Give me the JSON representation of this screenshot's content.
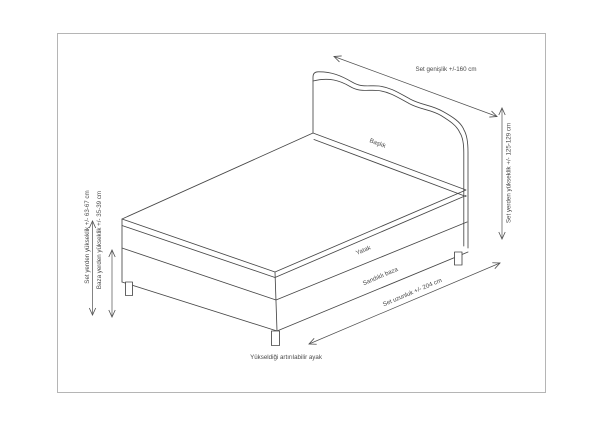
{
  "diagram": {
    "type": "technical-dimension-drawing",
    "subject": "bed-set",
    "parts": {
      "headboard": "Başlık",
      "mattress": "Yatak",
      "base": "Sandıklı baza",
      "leg": "Yükseldiği artırılabilir ayak"
    },
    "dim": {
      "width": "Set genişlik +/-160 cm",
      "height_total": "Set yerden yükseklik +/- 125-129 cm",
      "length": "Set uzunluk +/- 204 cm",
      "height_set": "Set yerden yükseklik +/- 63-67 cm",
      "height_base": "Baza yerden yükseklik +/- 35-39 cm"
    },
    "colors": {
      "line": "#474747",
      "dimension_line": "#4f4f4f",
      "text": "#4a4a4a",
      "border": "#b5b5b5",
      "background": "#ffffff"
    }
  }
}
